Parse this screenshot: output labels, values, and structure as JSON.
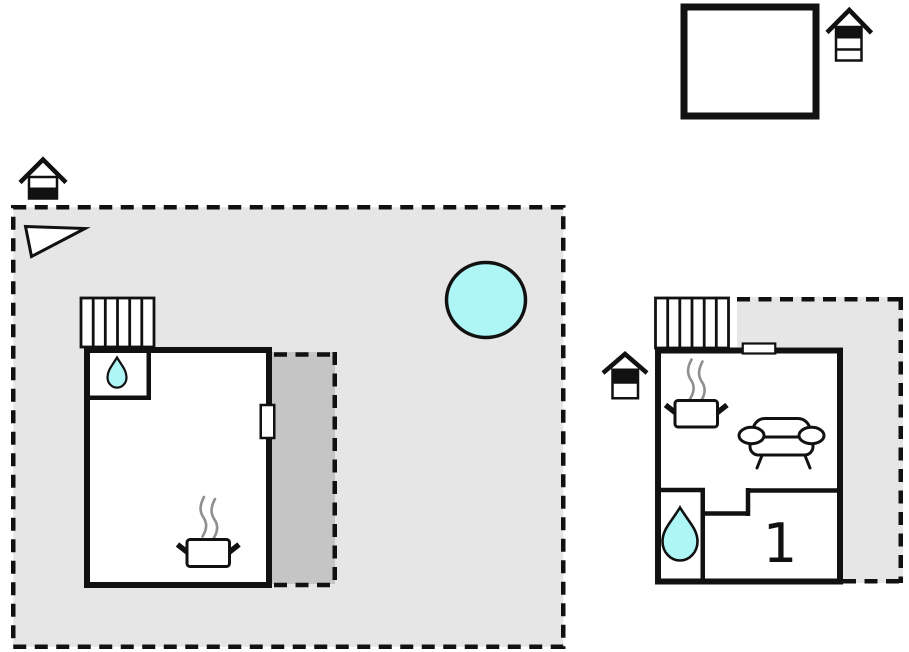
{
  "canvas": {
    "width": 909,
    "height": 652
  },
  "colors": {
    "background": "#ffffff",
    "plot_fill": "#e6e6e6",
    "patio_fill": "#c5c5c5",
    "water_fill": "#aef5f5",
    "wall": "#111111",
    "steam": "#8f8f8f"
  },
  "labels": {
    "bedroom": "1"
  },
  "icons": {
    "house_marker_annex": "house-floor-marker-top-band",
    "house_marker_main": "house-floor-marker-bottom-band",
    "house_marker_guest": "house-floor-marker-top-band",
    "water_drop": "water-drop",
    "stove": "pot-with-steam",
    "sofa": "sofa",
    "stairs": "stairs-hatch",
    "triangle": "direction-triangle",
    "pool": "hot-tub-circle"
  }
}
